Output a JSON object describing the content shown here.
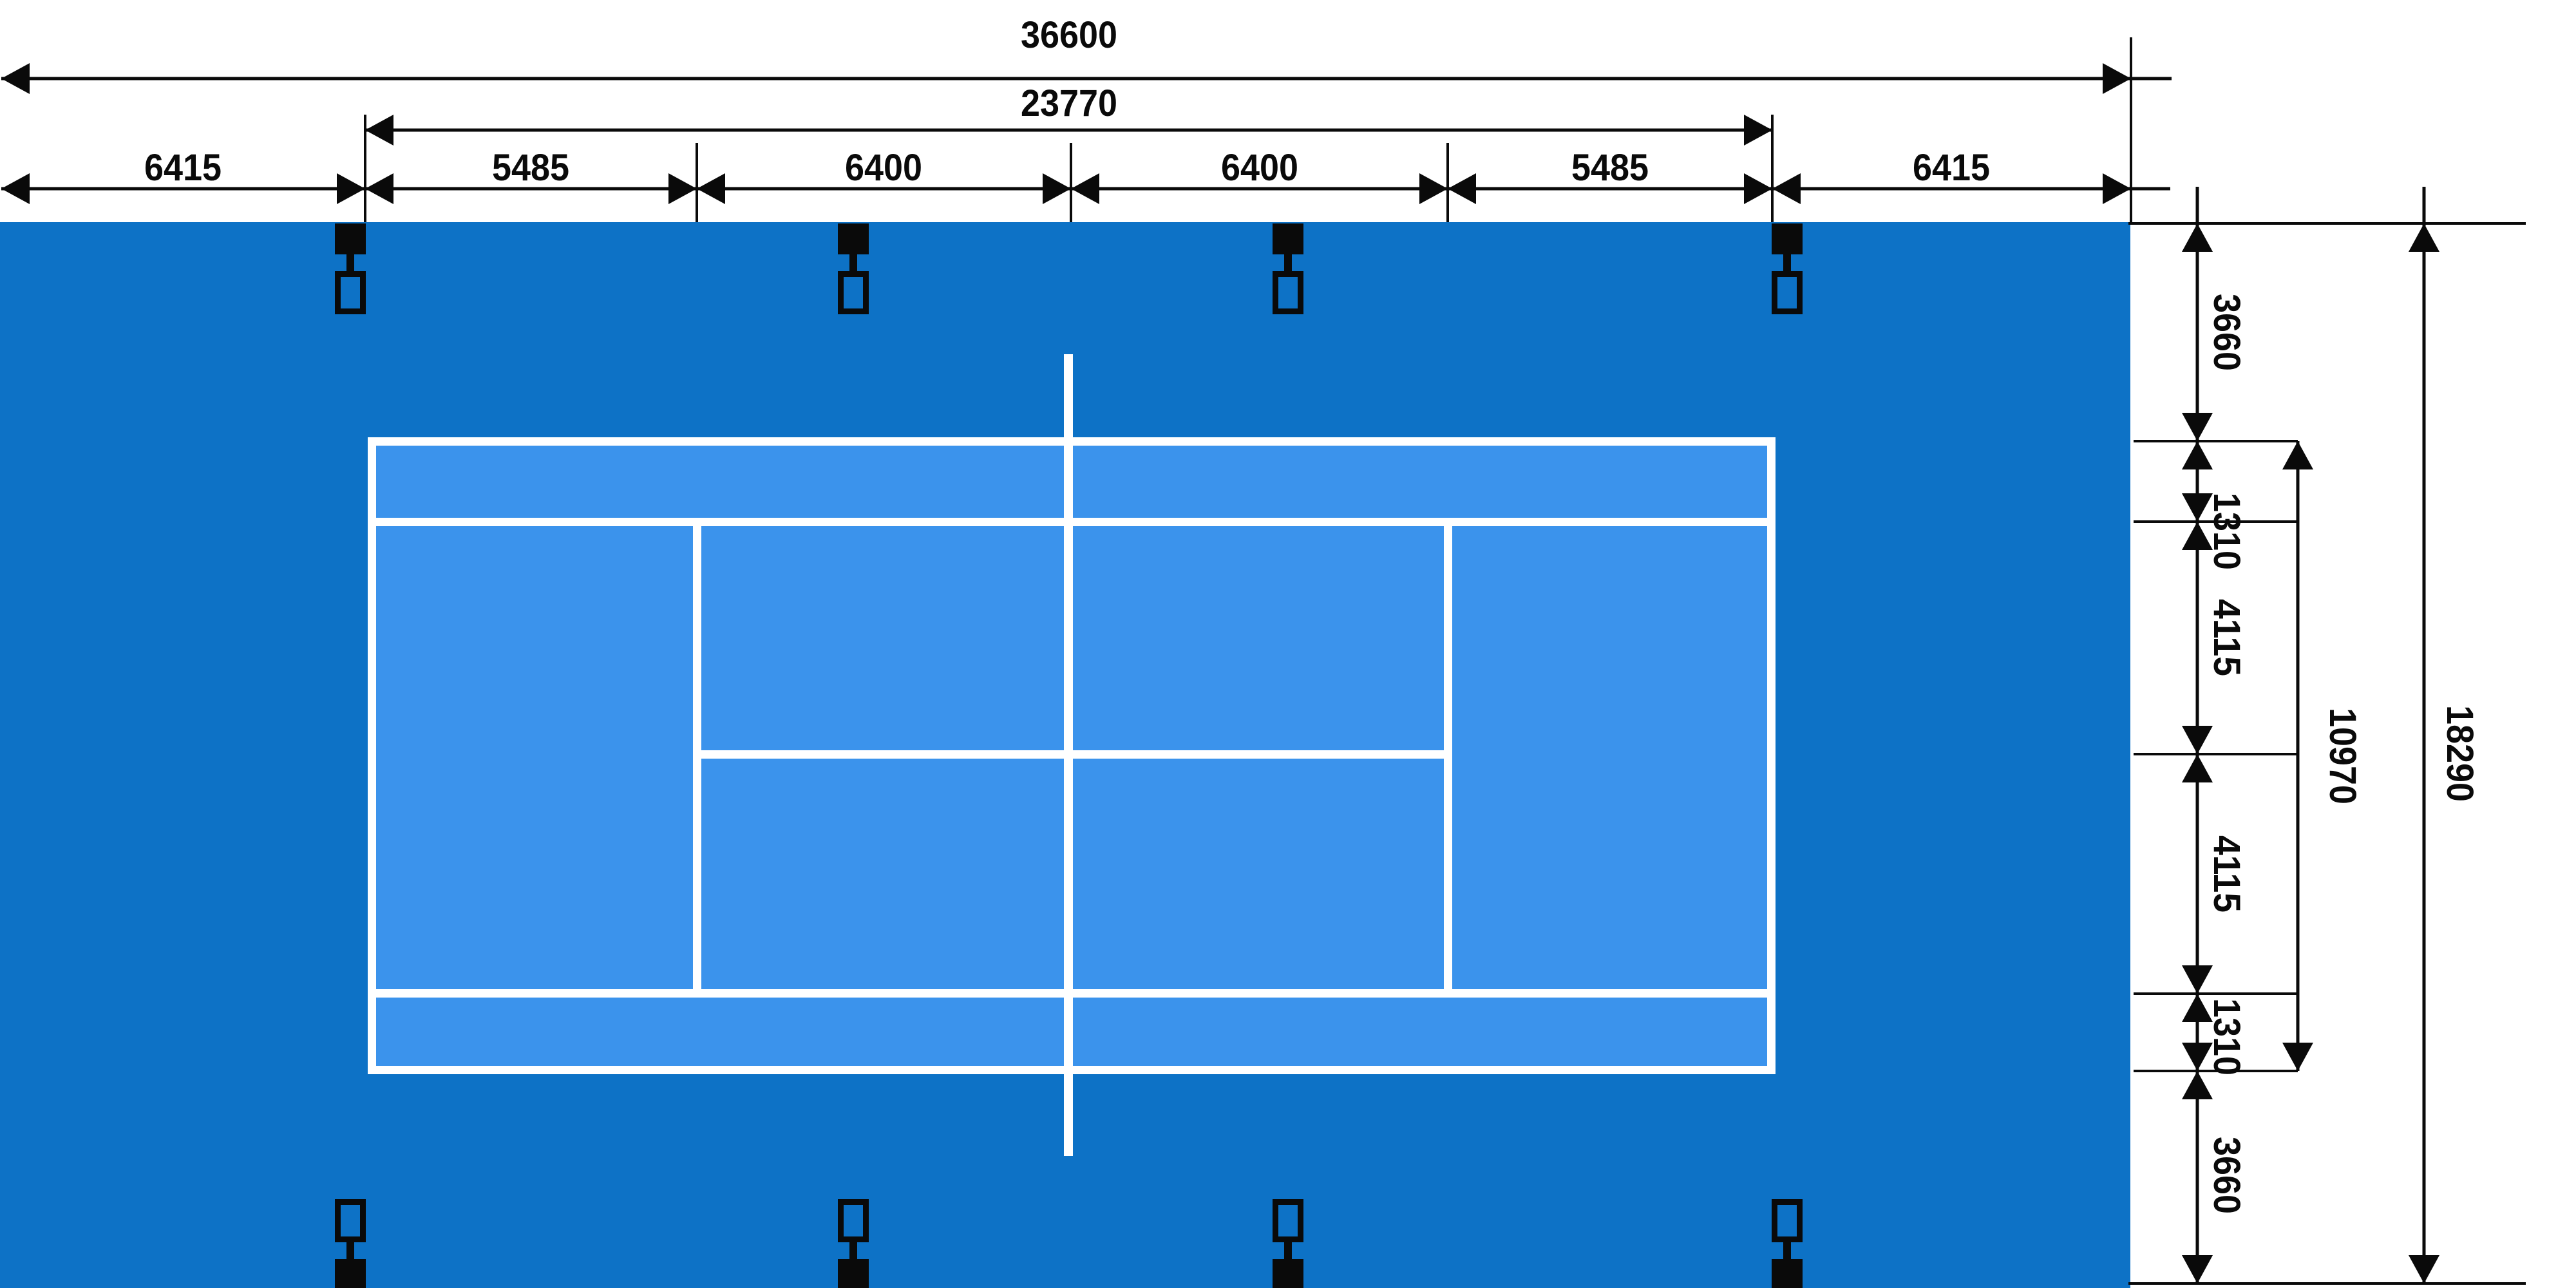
{
  "diagram": {
    "type": "tennis-court-dimension-plan",
    "overall_width_mm": "36600",
    "court_length_mm": "23770",
    "top_segments_mm": [
      "6415",
      "5485",
      "6400",
      "6400",
      "5485",
      "6415"
    ],
    "side_segments_mm": [
      "3660",
      "1310",
      "4115",
      "4115",
      "1310",
      "3660"
    ],
    "court_width_mm": "10970",
    "overall_depth_mm": "18290",
    "colors": {
      "apron_blue": "#0d72c6",
      "court_blue": "#3b93ec",
      "line_white": "#ffffff",
      "dimension_black": "#0a0a0a"
    }
  }
}
